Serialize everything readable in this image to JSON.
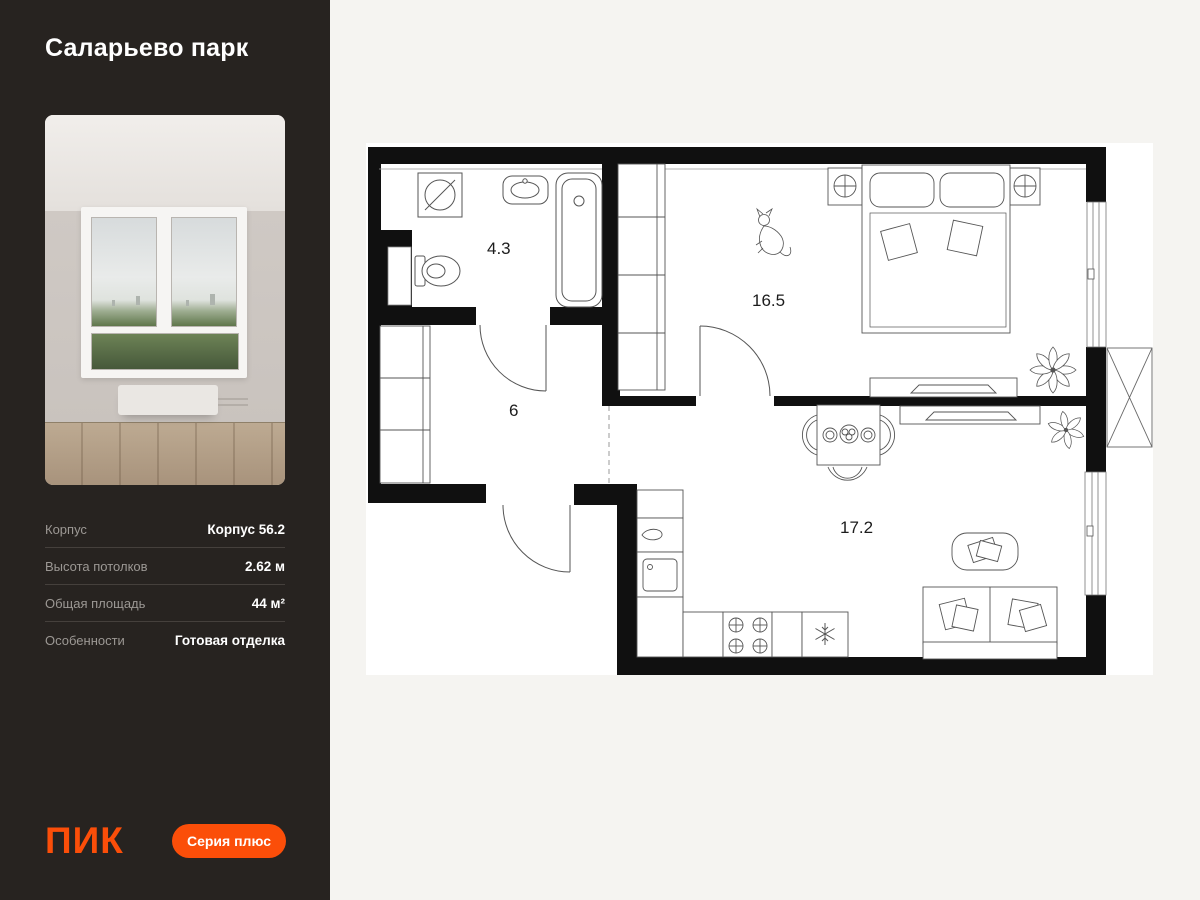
{
  "sidebar": {
    "title": "Саларьево парк",
    "specs": [
      {
        "label": "Корпус",
        "value": "Корпус 56.2"
      },
      {
        "label": "Высота потолков",
        "value": "2.62 м"
      },
      {
        "label": "Общая площадь",
        "value": "44 м²"
      },
      {
        "label": "Особенности",
        "value": "Готовая отделка"
      }
    ],
    "footer": {
      "logo": "ПИК",
      "badge": "Серия плюс"
    }
  },
  "plan": {
    "rooms": [
      {
        "name": "bathroom",
        "area": "4.3"
      },
      {
        "name": "hallway",
        "area": "6"
      },
      {
        "name": "bedroom",
        "area": "16.5"
      },
      {
        "name": "kitchen-living",
        "area": "17.2"
      }
    ]
  },
  "colors": {
    "accent": "#fb4e09",
    "sidebar_bg": "#272320",
    "page_bg": "#f5f4f1",
    "wall": "#101010"
  }
}
